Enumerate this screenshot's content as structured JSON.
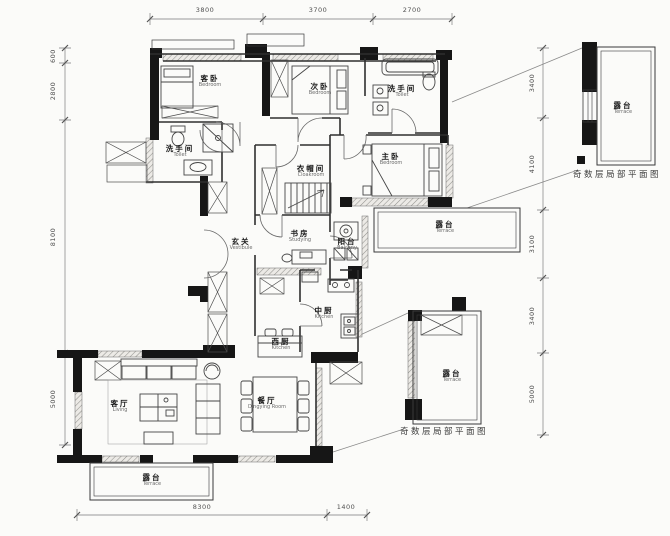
{
  "rooms": [
    {
      "id": "guest-bedroom",
      "cn": "客卧",
      "en": "Bedroom"
    },
    {
      "id": "second-bedroom",
      "cn": "次卧",
      "en": "Bedroom"
    },
    {
      "id": "toilet-left",
      "cn": "洗手间",
      "en": "Toilet"
    },
    {
      "id": "toilet-right",
      "cn": "洗手间",
      "en": "Toilet"
    },
    {
      "id": "master-bedroom",
      "cn": "主卧",
      "en": "Bedroom"
    },
    {
      "id": "cloakroom",
      "cn": "衣帽间",
      "en": "Cloakroom"
    },
    {
      "id": "vestibule",
      "cn": "玄关",
      "en": "Vestibule"
    },
    {
      "id": "study",
      "cn": "书房",
      "en": "Studying"
    },
    {
      "id": "balcony",
      "cn": "阳台",
      "en": "Balcony"
    },
    {
      "id": "kitchen-middle",
      "cn": "中厨",
      "en": "Kitchen"
    },
    {
      "id": "kitchen-west",
      "cn": "西厨",
      "en": "Kitchen"
    },
    {
      "id": "dining-room",
      "cn": "餐厅",
      "en": "Dingying Room"
    },
    {
      "id": "living-room",
      "cn": "客厅",
      "en": "Living"
    },
    {
      "id": "terrace-south",
      "cn": "露台",
      "en": "Terrace"
    },
    {
      "id": "terrace-east",
      "cn": "露台",
      "en": "Terrace"
    },
    {
      "id": "terrace-detail-upper",
      "cn": "露台",
      "en": "Terrace"
    },
    {
      "id": "terrace-detail-lower",
      "cn": "露台",
      "en": "Terrace"
    }
  ],
  "captions": [
    "奇数层局部平面图",
    "奇数层局部平面图"
  ],
  "dimensions": {
    "top": [
      "3800",
      "3700",
      "2700"
    ],
    "left": [
      "600",
      "2800",
      "8100",
      "5000"
    ],
    "right": [
      "3400",
      "4100",
      "3100",
      "3400",
      "5000"
    ],
    "bottom": [
      "8300",
      "1400"
    ]
  },
  "colors": {
    "wall": "#161616",
    "line": "#2f2f2f",
    "dim_text": "#4f4f4f"
  }
}
